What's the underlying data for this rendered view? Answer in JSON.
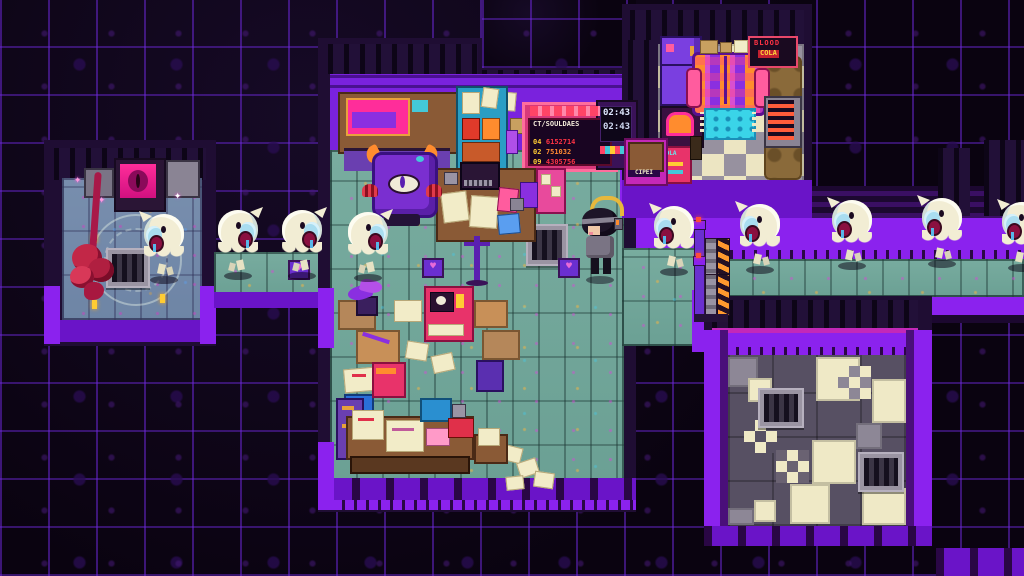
{
  "signs": {
    "soul_board": {
      "header": "CT/SOULDAES",
      "rows": [
        {
          "id": "04",
          "num": "6152714"
        },
        {
          "id": "02",
          "num": "751032"
        },
        {
          "id": "09",
          "num": "4305756"
        }
      ]
    },
    "ticket_clock": {
      "line1": "02:43",
      "line2": "02:43"
    },
    "poster": {
      "line1": "BLOOD",
      "line2": "COLA"
    },
    "kiosk": {
      "label": "CIPEI"
    },
    "vending": {
      "label": "COLA"
    }
  },
  "icons": {
    "heart": "♥",
    "sparkle": "✦"
  },
  "entities": {
    "ghost_count": 9,
    "ghosts": [
      {
        "x": 140,
        "y": 204,
        "facing": "left"
      },
      {
        "x": 214,
        "y": 200,
        "facing": "right"
      },
      {
        "x": 278,
        "y": 200,
        "facing": "right"
      },
      {
        "x": 344,
        "y": 202,
        "facing": "right"
      },
      {
        "x": 650,
        "y": 196,
        "facing": "left"
      },
      {
        "x": 736,
        "y": 194,
        "facing": "left"
      },
      {
        "x": 828,
        "y": 190,
        "facing": "left"
      },
      {
        "x": 918,
        "y": 188,
        "facing": "left"
      },
      {
        "x": 998,
        "y": 192,
        "facing": "left"
      }
    ],
    "barriers": [
      {
        "x": 694,
        "y": 220
      },
      {
        "x": 694,
        "y": 256
      }
    ]
  },
  "palette": {
    "background": "#0a0310",
    "grid_glow": "#6e28dc",
    "wall_purple": "#7a22dd",
    "bright_purple": "#8b22ee",
    "floor_teal": "#76ab9e",
    "tile_cream": "#efe9c6",
    "tile_gray": "#575063",
    "ghost_body": "#f2edd4",
    "accent_magenta": "#e02cd0",
    "hazard_orange": "#ff8c2e",
    "sign_red": "#ff3344",
    "sign_yellow": "#ffcc33"
  }
}
